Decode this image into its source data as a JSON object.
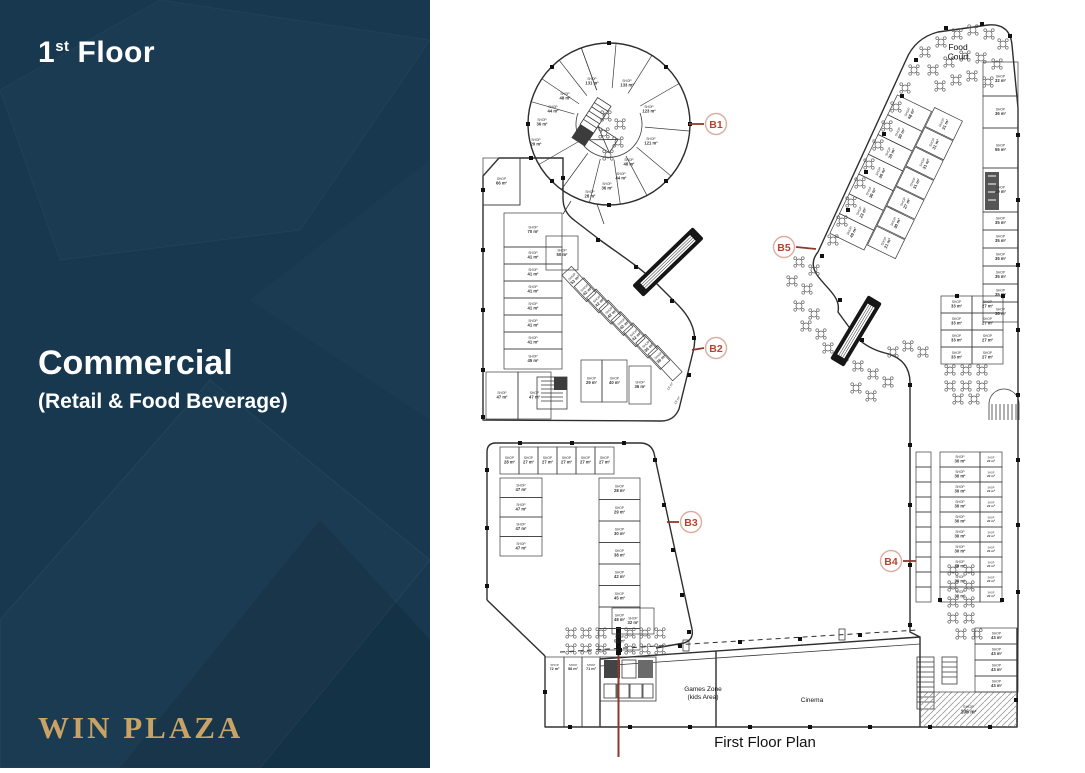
{
  "sidebar": {
    "floor_number": "1",
    "floor_ordinal": "st",
    "floor_word": "Floor",
    "title": "Commercial",
    "subtitle": "(Retail & Food Beverage)",
    "brand": "WIN PLAZA",
    "colors": {
      "background": "#17384f",
      "text": "#ffffff",
      "brand_gold": "#c9a265"
    }
  },
  "plan": {
    "caption": "First Floor Plan",
    "shop_word": "SHOP",
    "unit": "m²",
    "colors": {
      "line": "#2e2e2e",
      "marker_text": "#b4452e",
      "marker_ring": "#dcab9d",
      "leader": "#8a3a2c",
      "section_line": "#8a3a2c"
    },
    "markers": [
      {
        "id": "B1"
      },
      {
        "id": "B2"
      },
      {
        "id": "B3"
      },
      {
        "id": "B4"
      },
      {
        "id": "B5"
      }
    ],
    "area_labels": {
      "food_court": [
        "Food",
        "Court"
      ],
      "games_zone": [
        "Games Zone",
        "(kids Area)"
      ],
      "cinema": [
        "Cinema"
      ]
    },
    "groups": {
      "circle_shops": [
        "131",
        "133",
        "123",
        "121",
        "48",
        "44",
        "36",
        "28",
        "48",
        "44",
        "36",
        "20"
      ],
      "shop_66": [
        "66"
      ],
      "left_col": [
        "70",
        "41",
        "41",
        "41",
        "41",
        "41",
        "41",
        "45"
      ],
      "row_47": [
        "47",
        "47"
      ],
      "shop_50": [
        "50"
      ],
      "b2_diag": [
        "53",
        "42",
        "42",
        "42",
        "42",
        "42",
        "36",
        "36"
      ],
      "b2_bottom": [
        "29",
        "40",
        "36"
      ],
      "corridor_19": [
        "19",
        "19"
      ],
      "b3_top": [
        "28",
        "27",
        "27",
        "27",
        "27",
        "27"
      ],
      "b3_left": [
        "47",
        "47",
        "47",
        "47"
      ],
      "b3_right": [
        "28",
        "29",
        "30",
        "38",
        "42",
        "45",
        "48",
        "52"
      ],
      "shop_32b": [
        "32"
      ],
      "fc_outer": [
        "49",
        "23",
        "30",
        "30",
        "30",
        "30",
        "48"
      ],
      "fc_inner": [
        "21",
        "30",
        "27",
        "31",
        "31",
        "31",
        "31"
      ],
      "right_col": [
        "32",
        "36",
        "55",
        "49",
        "35",
        "35",
        "35",
        "35",
        "35",
        "38"
      ],
      "block_33": [
        "33",
        "33",
        "33",
        "33"
      ],
      "block_27": [
        "27",
        "27",
        "27",
        "27"
      ],
      "b4_left": [
        "30",
        "30",
        "30",
        "30",
        "30",
        "30",
        "30",
        "30",
        "30",
        "30"
      ],
      "b4_right": [
        "22",
        "22",
        "22",
        "22",
        "22",
        "22",
        "22",
        "22",
        "22",
        "22"
      ],
      "col_43": [
        "43",
        "43",
        "43",
        "43"
      ],
      "shop_106": [
        "106"
      ],
      "bottom_left": [
        "72",
        "58",
        "71"
      ]
    }
  }
}
